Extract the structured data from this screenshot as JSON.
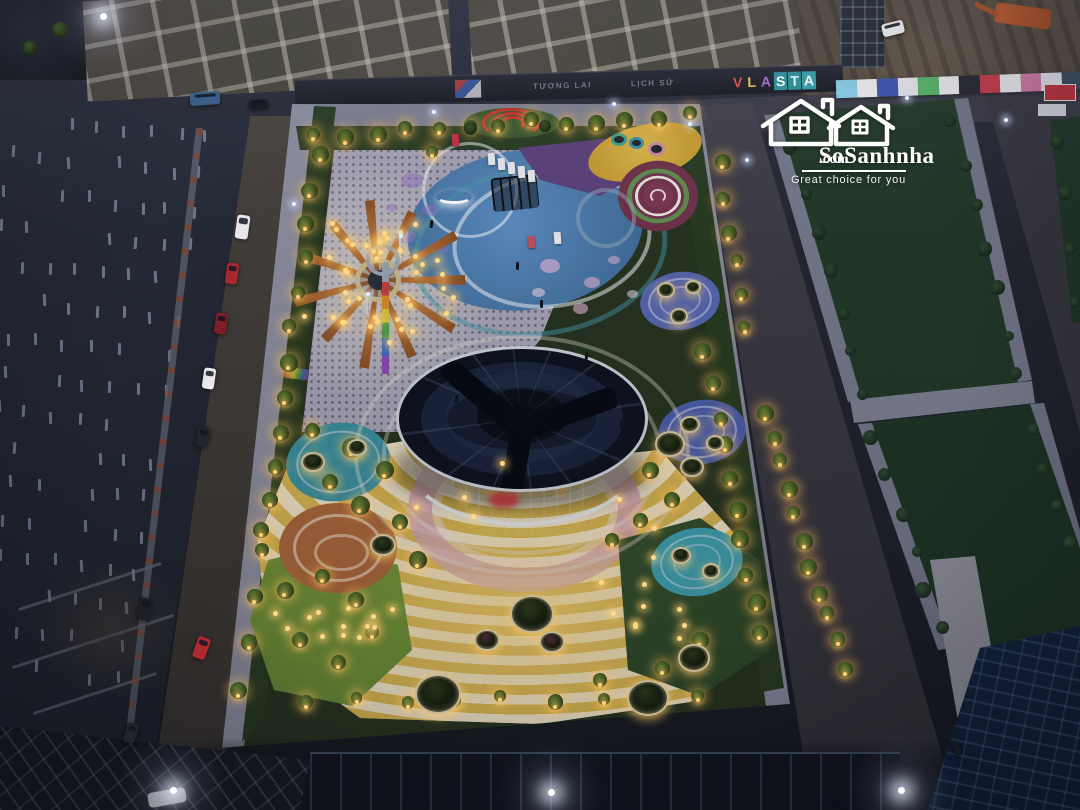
{
  "watermark": {
    "brand": "SoSanhnha",
    "suffix": ".com",
    "tagline": "Great choice for you",
    "color": "#ffffff"
  },
  "billboards": {
    "left_text": "TƯƠNG LAI",
    "right_text": "LỊCH SỬ",
    "brand_letters": [
      "V",
      "L",
      "A",
      "S",
      "T",
      "A"
    ],
    "brand_colors": [
      "#e05050",
      "#e8c84a",
      "#9a6fd0",
      "#ffffff",
      "#eafefe",
      "#ffffff"
    ],
    "brand_panels": [
      "transparent",
      "transparent",
      "transparent",
      "#2e8f98",
      "#2e8f98",
      "#35a0a8"
    ]
  },
  "hoarding_panels": [
    "#8ad0e8",
    "#f2f2f2",
    "#3a55b0",
    "#ececf2",
    "#58b868",
    "#f2f2f2",
    "#24242c",
    "#cc3a4a",
    "#f2f2f2",
    "#d87aa8",
    "#e8e8ee",
    "#3a4a60"
  ],
  "colors": {
    "glow_warm": "#ffd98a",
    "roof": "#0c101c",
    "plaza_yellow": "#d8b84a",
    "plaza_pink": "#c9a2b6",
    "terracotta": "#a8663a",
    "teal_pad": "#3f9fae",
    "blue_pad": "#4a5fa8",
    "sun_orange": "#b5713a",
    "lawn_lit": "#87a33f"
  },
  "sun_rays": [
    0,
    33,
    66,
    99,
    132,
    165,
    198,
    231,
    264,
    297,
    330
  ],
  "cars": [
    {
      "x": 242,
      "y": 227,
      "w": 13,
      "h": 24,
      "rot": 8,
      "color": "#e6e6ea",
      "name": "white-van"
    },
    {
      "x": 232,
      "y": 273,
      "w": 12,
      "h": 21,
      "rot": 8,
      "color": "#a82830",
      "name": "red-car"
    },
    {
      "x": 221,
      "y": 323,
      "w": 12,
      "h": 21,
      "rot": 8,
      "color": "#7e1e26",
      "name": "dark-red-car"
    },
    {
      "x": 209,
      "y": 378,
      "w": 12,
      "h": 21,
      "rot": 8,
      "color": "#e8e8ec",
      "name": "white-car"
    },
    {
      "x": 203,
      "y": 437,
      "w": 12,
      "h": 20,
      "rot": 9,
      "color": "#23262e",
      "name": "dark-car"
    },
    {
      "x": 144,
      "y": 609,
      "w": 13,
      "h": 22,
      "rot": 14,
      "color": "#1c1f26",
      "name": "dark-car"
    },
    {
      "x": 201,
      "y": 648,
      "w": 13,
      "h": 22,
      "rot": 20,
      "color": "#b02830",
      "name": "red-car"
    },
    {
      "x": 131,
      "y": 733,
      "w": 12,
      "h": 20,
      "rot": 16,
      "color": "#20242c",
      "name": "dark-car"
    },
    {
      "x": 205,
      "y": 98,
      "w": 30,
      "h": 13,
      "rot": -4,
      "color": "#3a5f8a",
      "name": "blue-truck"
    },
    {
      "x": 258,
      "y": 104,
      "w": 19,
      "h": 9,
      "rot": -4,
      "color": "#1a1d24",
      "name": "dark-truck"
    },
    {
      "x": 956,
      "y": 748,
      "w": 7,
      "h": 14,
      "rot": -18,
      "color": "#15181e",
      "name": "motorbike"
    },
    {
      "x": 893,
      "y": 28,
      "w": 22,
      "h": 13,
      "rot": -14,
      "color": "#dcdce0",
      "name": "white-suv"
    }
  ],
  "planters": [
    {
      "x": 532,
      "y": 614,
      "r": 22,
      "tree": "#2a361c"
    },
    {
      "x": 487,
      "y": 640,
      "r": 13,
      "tree": "#4a2a30"
    },
    {
      "x": 552,
      "y": 642,
      "r": 13,
      "tree": "#4a2a30"
    },
    {
      "x": 438,
      "y": 694,
      "r": 23,
      "tree": "#26331a"
    },
    {
      "x": 648,
      "y": 698,
      "r": 21,
      "tree": "#26331a"
    },
    {
      "x": 694,
      "y": 658,
      "r": 16,
      "tree": "#26331a"
    },
    {
      "x": 383,
      "y": 545,
      "r": 13,
      "tree": "#2a361c"
    },
    {
      "x": 670,
      "y": 444,
      "r": 15,
      "tree": "#2a361c"
    },
    {
      "x": 692,
      "y": 467,
      "r": 12,
      "tree": "#2a361c"
    },
    {
      "x": 313,
      "y": 462,
      "r": 12,
      "tree": "#2a361c"
    },
    {
      "x": 357,
      "y": 447,
      "r": 10,
      "tree": "#2a361c"
    },
    {
      "x": 666,
      "y": 290,
      "r": 9,
      "tree": "#2a361c"
    },
    {
      "x": 693,
      "y": 287,
      "r": 8,
      "tree": "#2a361c"
    },
    {
      "x": 679,
      "y": 316,
      "r": 9,
      "tree": "#2a361c"
    },
    {
      "x": 690,
      "y": 424,
      "r": 10,
      "tree": "#2a361c"
    },
    {
      "x": 715,
      "y": 443,
      "r": 9,
      "tree": "#2a361c"
    },
    {
      "x": 681,
      "y": 555,
      "r": 10,
      "tree": "#2a361c"
    },
    {
      "x": 711,
      "y": 571,
      "r": 9,
      "tree": "#2a361c"
    }
  ],
  "tree_lines": [
    {
      "x1": 316,
      "y1": 136,
      "x2": 688,
      "y2": 114,
      "n": 13,
      "lit": true,
      "s": 15
    },
    {
      "x1": 318,
      "y1": 156,
      "x2": 262,
      "y2": 532,
      "n": 12,
      "lit": true,
      "s": 16
    },
    {
      "x1": 258,
      "y1": 548,
      "x2": 242,
      "y2": 688,
      "n": 4,
      "lit": true,
      "s": 15
    },
    {
      "x1": 705,
      "y1": 352,
      "x2": 762,
      "y2": 636,
      "n": 10,
      "lit": true,
      "s": 16
    },
    {
      "x1": 722,
      "y1": 165,
      "x2": 745,
      "y2": 330,
      "n": 6,
      "lit": true,
      "s": 14
    },
    {
      "x1": 766,
      "y1": 412,
      "x2": 843,
      "y2": 668,
      "n": 11,
      "lit": true,
      "s": 15
    },
    {
      "x1": 306,
      "y1": 700,
      "x2": 700,
      "y2": 699,
      "n": 9,
      "lit": true,
      "s": 13
    },
    {
      "x1": 790,
      "y1": 150,
      "x2": 866,
      "y2": 392,
      "n": 7,
      "lit": false,
      "s": 13
    },
    {
      "x1": 952,
      "y1": 122,
      "x2": 1016,
      "y2": 376,
      "n": 7,
      "lit": false,
      "s": 13
    },
    {
      "x1": 874,
      "y1": 440,
      "x2": 940,
      "y2": 628,
      "n": 6,
      "lit": false,
      "s": 13
    },
    {
      "x1": 1032,
      "y1": 428,
      "x2": 1074,
      "y2": 545,
      "n": 4,
      "lit": false,
      "s": 12
    },
    {
      "x1": 1056,
      "y1": 140,
      "x2": 1078,
      "y2": 300,
      "n": 4,
      "lit": false,
      "s": 12
    }
  ],
  "trees": [
    {
      "x": 352,
      "y": 448,
      "s": 20,
      "lit": true
    },
    {
      "x": 385,
      "y": 470,
      "s": 18,
      "lit": true
    },
    {
      "x": 360,
      "y": 505,
      "s": 19,
      "lit": true
    },
    {
      "x": 400,
      "y": 522,
      "s": 16,
      "lit": true
    },
    {
      "x": 330,
      "y": 482,
      "s": 16,
      "lit": true
    },
    {
      "x": 418,
      "y": 560,
      "s": 18,
      "lit": true
    },
    {
      "x": 312,
      "y": 430,
      "s": 15,
      "lit": true
    },
    {
      "x": 650,
      "y": 470,
      "s": 17,
      "lit": true
    },
    {
      "x": 672,
      "y": 500,
      "s": 16,
      "lit": true
    },
    {
      "x": 640,
      "y": 520,
      "s": 15,
      "lit": true
    },
    {
      "x": 612,
      "y": 540,
      "s": 14,
      "lit": true
    },
    {
      "x": 700,
      "y": 640,
      "s": 17,
      "lit": true
    },
    {
      "x": 662,
      "y": 668,
      "s": 15,
      "lit": true
    },
    {
      "x": 600,
      "y": 680,
      "s": 14,
      "lit": true
    },
    {
      "x": 285,
      "y": 590,
      "s": 17,
      "lit": true
    },
    {
      "x": 322,
      "y": 576,
      "s": 15,
      "lit": true
    },
    {
      "x": 356,
      "y": 600,
      "s": 16,
      "lit": true
    },
    {
      "x": 300,
      "y": 640,
      "s": 16,
      "lit": true
    },
    {
      "x": 338,
      "y": 662,
      "s": 15,
      "lit": true
    },
    {
      "x": 372,
      "y": 632,
      "s": 14,
      "lit": true
    },
    {
      "x": 470,
      "y": 128,
      "s": 13,
      "lit": false
    },
    {
      "x": 545,
      "y": 126,
      "s": 12,
      "lit": false
    },
    {
      "x": 432,
      "y": 152,
      "s": 12,
      "lit": true
    },
    {
      "x": 60,
      "y": 30,
      "s": 16,
      "lit": false
    },
    {
      "x": 30,
      "y": 48,
      "s": 14,
      "lit": false
    }
  ],
  "light_clusters": [
    {
      "cx": 378,
      "cy": 280,
      "rmin": 30,
      "rmax": 92,
      "n": 42
    },
    {
      "cx": 330,
      "cy": 625,
      "rmin": 8,
      "rmax": 66,
      "n": 12
    },
    {
      "cx": 520,
      "cy": 560,
      "rmin": 70,
      "rmax": 150,
      "n": 9
    },
    {
      "cx": 660,
      "cy": 615,
      "rmin": 8,
      "rmax": 52,
      "n": 8
    }
  ],
  "work_lights": [
    {
      "x": 100,
      "y": 13
    },
    {
      "x": 170,
      "y": 787
    },
    {
      "x": 548,
      "y": 789
    },
    {
      "x": 898,
      "y": 787
    }
  ],
  "cool_lights": [
    {
      "x": 292,
      "y": 202
    },
    {
      "x": 399,
      "y": 234
    },
    {
      "x": 366,
      "y": 292
    },
    {
      "x": 688,
      "y": 122
    },
    {
      "x": 745,
      "y": 158
    },
    {
      "x": 1004,
      "y": 118
    },
    {
      "x": 905,
      "y": 96
    },
    {
      "x": 432,
      "y": 110
    },
    {
      "x": 612,
      "y": 102
    }
  ],
  "pillars": {
    "x0": 16,
    "y0": 112,
    "cols": 8,
    "rows": 16,
    "cdx": 27,
    "cdy": 3,
    "rdx": -6,
    "rdy": 36,
    "w": 3,
    "h": 12
  },
  "figures": [
    {
      "x": 516,
      "y": 262
    },
    {
      "x": 497,
      "y": 356
    },
    {
      "x": 455,
      "y": 395
    },
    {
      "x": 585,
      "y": 352
    },
    {
      "x": 620,
      "y": 420
    },
    {
      "x": 430,
      "y": 220
    },
    {
      "x": 540,
      "y": 300
    }
  ],
  "trampolines": [
    {
      "x": 611,
      "y": 133,
      "s": 16,
      "ring": "#3aa089"
    },
    {
      "x": 629,
      "y": 137,
      "s": 15,
      "ring": "#3a8fa0"
    },
    {
      "x": 648,
      "y": 142,
      "s": 17,
      "ring": "#c88aa0"
    }
  ],
  "splashes": [
    {
      "x": 550,
      "y": 266,
      "s": 20,
      "c": "rgba(230,180,215,0.65)"
    },
    {
      "x": 592,
      "y": 282,
      "s": 16,
      "c": "rgba(230,180,215,0.6)"
    },
    {
      "x": 538,
      "y": 292,
      "s": 13,
      "c": "rgba(240,210,230,0.6)"
    },
    {
      "x": 614,
      "y": 260,
      "s": 12,
      "c": "rgba(230,180,215,0.55)"
    },
    {
      "x": 580,
      "y": 308,
      "s": 15,
      "c": "rgba(230,180,215,0.6)"
    },
    {
      "x": 632,
      "y": 294,
      "s": 11,
      "c": "rgba(240,220,235,0.55)"
    },
    {
      "x": 412,
      "y": 180,
      "s": 22,
      "c": "rgba(150,110,190,0.5)"
    },
    {
      "x": 430,
      "y": 210,
      "s": 16,
      "c": "rgba(150,110,190,0.45)"
    },
    {
      "x": 406,
      "y": 236,
      "s": 19,
      "c": "rgba(165,120,200,0.45)"
    },
    {
      "x": 442,
      "y": 248,
      "s": 13,
      "c": "rgba(150,110,190,0.4)"
    },
    {
      "x": 392,
      "y": 208,
      "s": 12,
      "c": "rgba(150,110,190,0.4)"
    }
  ],
  "sign_boards": [
    {
      "x": 452,
      "y": 134,
      "c": "#c03040"
    },
    {
      "x": 488,
      "y": 153,
      "c": "#e8e8ec"
    },
    {
      "x": 498,
      "y": 158,
      "c": "#e8e8ec"
    },
    {
      "x": 508,
      "y": 162,
      "c": "#e8e8ec"
    },
    {
      "x": 518,
      "y": 166,
      "c": "#e8e8ec"
    },
    {
      "x": 528,
      "y": 170,
      "c": "#e8e8ec"
    },
    {
      "x": 528,
      "y": 236,
      "c": "#c05060"
    },
    {
      "x": 554,
      "y": 232,
      "c": "#e8e8ec"
    }
  ],
  "wall_lines": [
    {
      "x": 15,
      "y": 585,
      "w": 150,
      "rot": -18
    },
    {
      "x": 8,
      "y": 640,
      "w": 170,
      "rot": -18
    },
    {
      "x": 30,
      "y": 692,
      "w": 130,
      "rot": -18
    }
  ]
}
